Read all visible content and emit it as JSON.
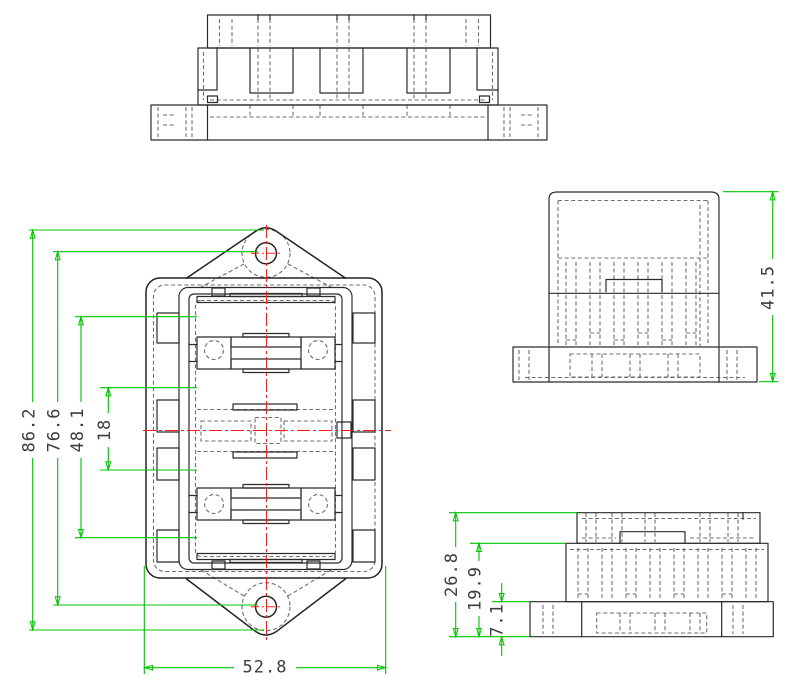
{
  "drawing": {
    "colors": {
      "background": "#ffffff",
      "outline": "#2b2b2b",
      "hidden_line": "#6f6f6f",
      "dimension_line": "#00c400",
      "centerline": "#ff1a1a",
      "dimension_text": "#3d3d3d"
    },
    "dimensions": {
      "front": {
        "overall_height": "86.2",
        "hole_center_spacing": "76.6",
        "cavity_height": "48.1",
        "center_window_spacing": "18",
        "overall_width": "52.8"
      },
      "side": {
        "overall_height": "41.5"
      },
      "base_side": {
        "overall_height": "26.8",
        "body_height": "19.9",
        "flange_height": "7.1"
      }
    }
  }
}
